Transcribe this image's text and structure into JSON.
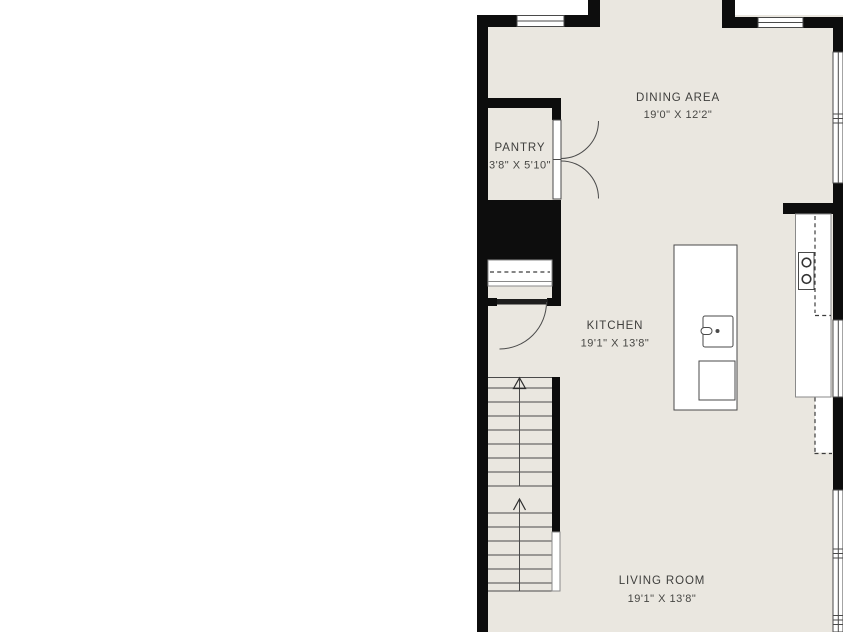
{
  "floorplan": {
    "rooms": {
      "dining": {
        "label": "DINING AREA",
        "dims": "19'0\" X 12'2\""
      },
      "pantry": {
        "label": "PANTRY",
        "dims": "3'8\" X 5'10\""
      },
      "kitchen": {
        "label": "KITCHEN",
        "dims": "19'1\" X 13'8\""
      },
      "living": {
        "label": "LIVING ROOM",
        "dims": "19'1\" X 13'8\""
      }
    },
    "colors": {
      "floor": "#eae7e0",
      "wall": "#0d0d0d",
      "fixture": "#ffffff",
      "line": "#4a4a4a",
      "text": "#3f3f3d"
    }
  }
}
